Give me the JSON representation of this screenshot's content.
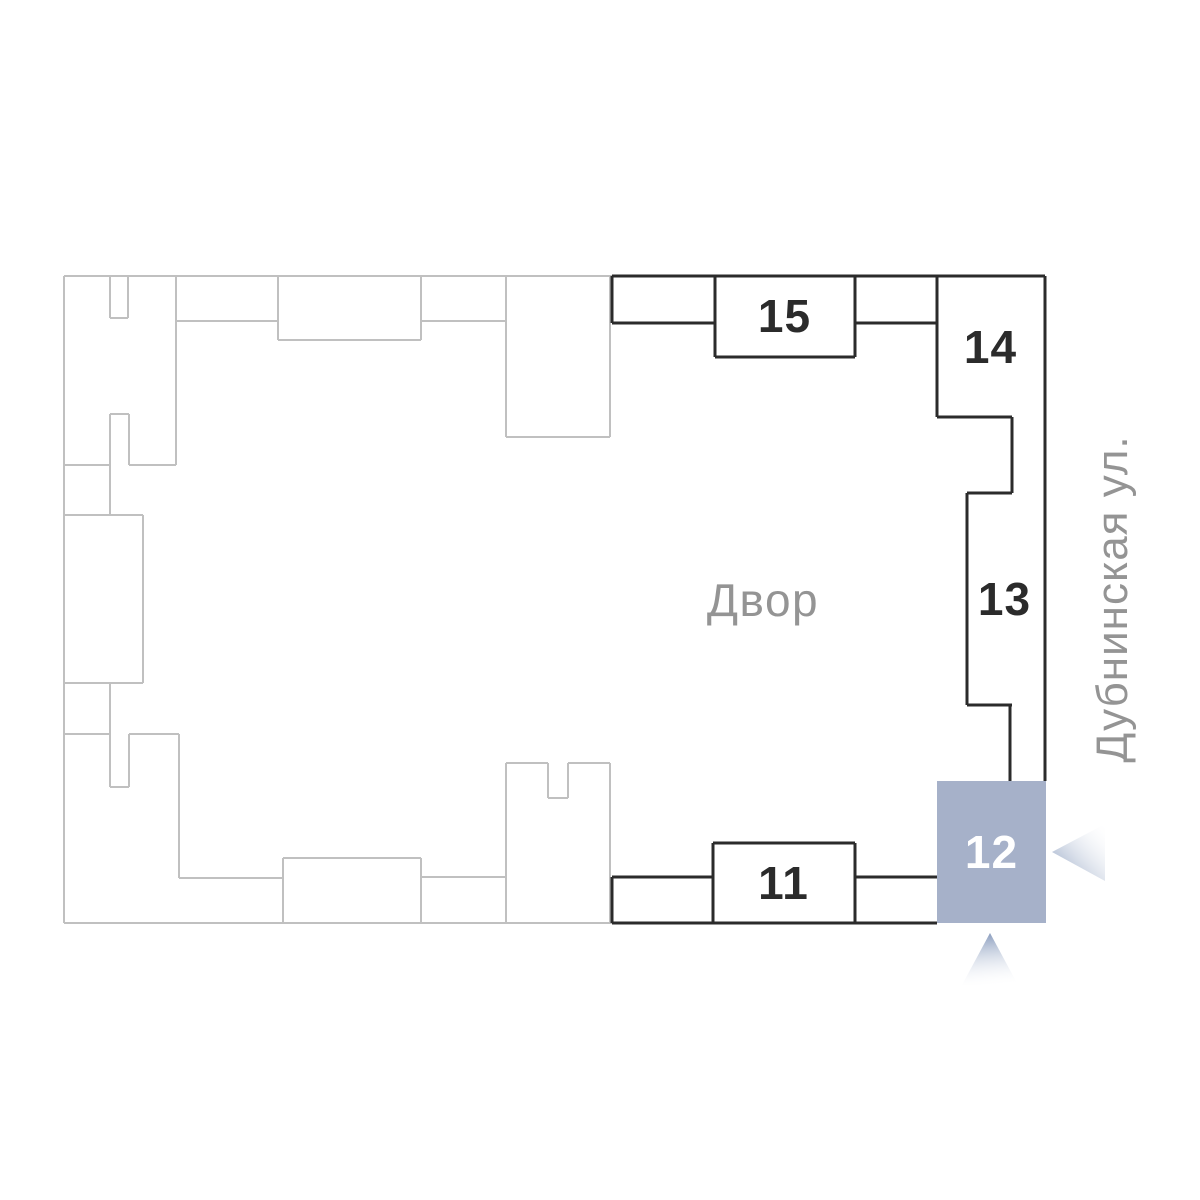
{
  "plan": {
    "courtyard_label": "Двор",
    "street_label": "Дубнинская ул.",
    "sections": [
      {
        "number": "15",
        "selected": false
      },
      {
        "number": "14",
        "selected": false
      },
      {
        "number": "13",
        "selected": false
      },
      {
        "number": "12",
        "selected": true
      },
      {
        "number": "11",
        "selected": false
      }
    ],
    "colors": {
      "outline_muted": "#c0c0c0",
      "outline_active": "#2b2b2b",
      "selected_fill": "#a6b1c9",
      "selected_text": "#ffffff",
      "label_text": "#949494",
      "number_text": "#2b2b2b",
      "marker_gradient_start": "#8a9dbe",
      "marker_gradient_end": "#ffffff"
    }
  }
}
